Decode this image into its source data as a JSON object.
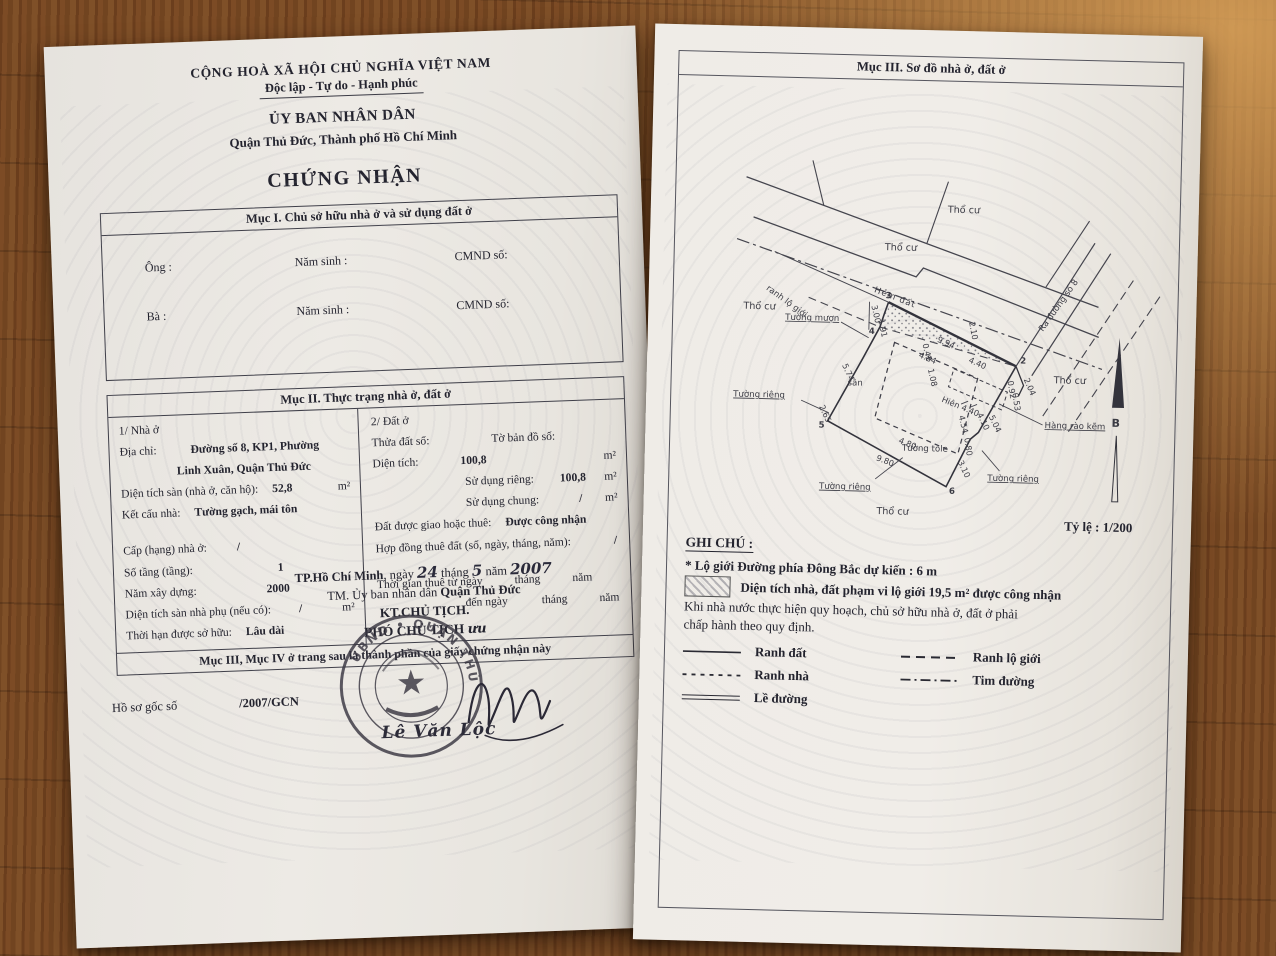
{
  "left_page": {
    "header": {
      "country": "CỘNG HOÀ XÃ HỘI CHỦ NGHĨA VIỆT NAM",
      "motto": "Độc lập - Tự do - Hạnh phúc",
      "committee": "ỦY BAN NHÂN DÂN",
      "district": "Quận Thủ Đức, Thành phố Hồ Chí Minh",
      "doc_title": "CHỨNG NHẬN"
    },
    "muc1": {
      "title": "Mục I. Chủ sở hữu nhà ở và sử dụng đất ở",
      "ong": "Ông :",
      "ba": "Bà :",
      "nam_sinh": "Năm sinh :",
      "cmnd": "CMND số:"
    },
    "muc2": {
      "title": "Mục II. Thực trạng nhà ở, đất ở",
      "house": {
        "heading": "1/ Nhà ở",
        "addr_label": "Địa chỉ:",
        "addr1": "Đường số 8, KP1, Phường",
        "addr2": "Linh Xuân, Quận Thủ Đức",
        "floor_label": "Diện tích sàn (nhà ở, căn hộ):",
        "floor_value": "52,8",
        "floor_unit": "m²",
        "struct_label": "Kết cấu nhà:",
        "struct_value": "Tường gạch, mái tôn",
        "grade_label": "Cấp (hạng) nhà ở:",
        "grade_value": "/",
        "floors_label": "Số tầng (tầng):",
        "floors_value": "1",
        "year_label": "Năm xây dựng:",
        "year_value": "2000",
        "aux_label": "Diện tích sàn nhà phụ (nếu có):",
        "aux_value": "/",
        "aux_unit": "m²",
        "term_label": "Thời hạn được sở hữu:",
        "term_value": "Lâu dài"
      },
      "land": {
        "heading": "2/ Đất ở",
        "parcel_label": "Thửa đất số:",
        "sheet_label": "Tờ bản đồ số:",
        "area_label": "Diện tích:",
        "area_value": "100,8",
        "area_unit": "m²",
        "priv_label": "Sử dụng riêng:",
        "priv_value": "100,8",
        "priv_unit": "m²",
        "shared_label": "Sử dụng chung:",
        "shared_value": "/",
        "shared_unit": "m²",
        "grant_label": "Đất được giao hoặc thuê:",
        "grant_value": "Được công nhận",
        "lease_label": "Hợp đồng thuê đất (số, ngày, tháng, năm):",
        "lease_value": "/",
        "time_from": "Thời gian thuê từ ngày",
        "time_to": "đến ngày",
        "month_word": "tháng",
        "year_word": "năm"
      },
      "note": "Mục III, Mục IV ở trang sau là thành phần của giấy chứng nhận này"
    },
    "signing": {
      "place": "TP.Hồ Chí Minh",
      "date_pre": ", ngày",
      "day": "24",
      "month_word": "tháng",
      "month": "5",
      "year_word": "năm",
      "year": "2007",
      "on_behalf": "TM. Ủy ban nhân dân",
      "on_behalf_bold": "Quận Thủ Đức",
      "kt": "KT.CHỦ TỊCH.",
      "deputy": "PHÓ CHỦ TỊCH",
      "deputy_initial": "ưu",
      "signer": "Lê Văn Lộc",
      "stamp_arc": "UBND • QUẬN THỦ ĐỨC •"
    },
    "docket": {
      "label": "Hồ sơ gốc số",
      "value": "/2007/GCN"
    }
  },
  "right_page": {
    "title": "Mục III. Sơ đồ nhà ở, đất ở",
    "scale_label": "Tỷ lệ : 1/200",
    "compass_b": "B",
    "diagram": {
      "tho_cu": "Thổ cư",
      "hem_dat": "Hẻm đất",
      "ranh_lo_gioi": "ranh lộ giới",
      "tuong_muon": "Tường mượn",
      "tuong_rieng": "Tường riêng",
      "tuong_tole": "Tường tole",
      "hang_rao": "Hàng rào kẽm",
      "ra_duong": "Ra đường số 8",
      "san": "sân",
      "hien": "Hiên  4.40",
      "dims": {
        "top": "9.94",
        "alley": "2.10",
        "strip": "4.40",
        "house_top": "4.84",
        "house_right": "4.54",
        "house_bottom": "4.80",
        "left_up": "5.74",
        "left_low": "2.65",
        "bottom": "9.80",
        "r1": "4.10",
        "r2": "5.04",
        "r3": "0.80",
        "r4": "3.10",
        "j1": "2.04",
        "j2": "0.92",
        "j3": "0.53",
        "c3a": "3.00",
        "c3b": "1.91",
        "s1": "0.42",
        "s2": "1.08"
      },
      "corners": {
        "c2": "2",
        "c3": "3",
        "c4": "4",
        "c5": "5",
        "c6": "6"
      }
    },
    "notes": {
      "title": "GHI CHÚ :",
      "line1": "* Lộ giới Đường phía Đông Bắc dự kiến : 6 m",
      "line2": "Diện tích nhà, đất phạm vi lộ giới 19,5 m² được công nhận",
      "line3": "Khi nhà nước thực hiện quy hoạch, chủ sở hữu nhà ở, đất ở phải",
      "line4": "chấp hành theo quy định.",
      "legend": {
        "ranh_dat": "Ranh đất",
        "ranh_lo_gioi": "Ranh lộ giới",
        "ranh_nha": "Ranh nhà",
        "tim_duong": "Tim đường",
        "le_duong": "Lề đường"
      }
    }
  }
}
